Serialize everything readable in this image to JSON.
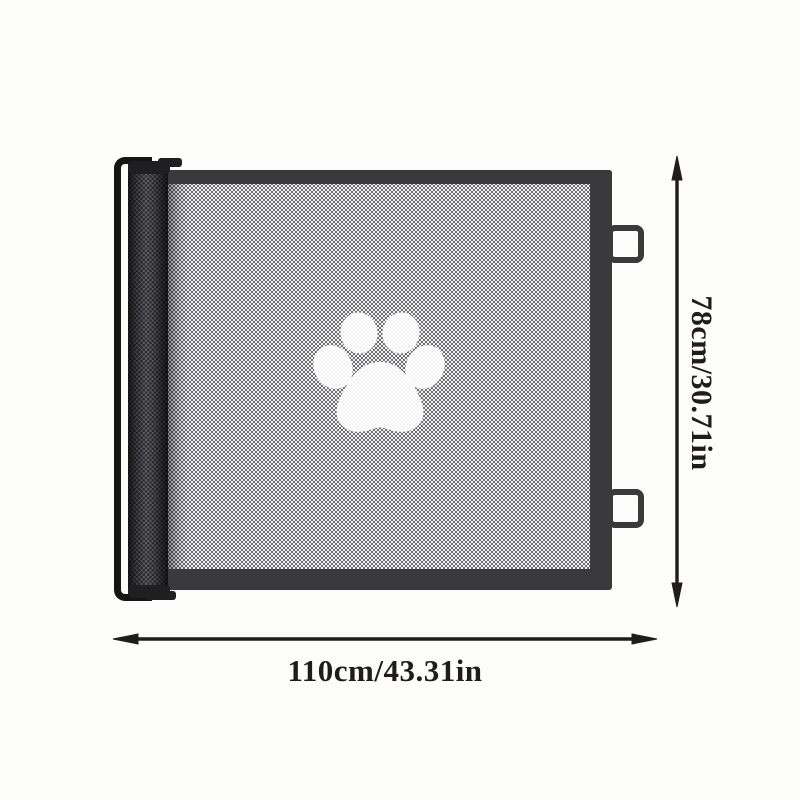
{
  "product": {
    "name": "retractable mesh pet gate",
    "paw_icon": "paw-print-icon"
  },
  "dimensions": {
    "height_label": "78cm/30.71in",
    "width_label": "110cm/43.31in"
  },
  "colors": {
    "background": "#fcfcfa",
    "frame": "#3a3a3c",
    "rod": "#151515",
    "mesh_base": "#4a4a50",
    "mesh_dot": "#f2f2f0",
    "annotation": "#1f1c1d",
    "paw": "#ffffff"
  }
}
